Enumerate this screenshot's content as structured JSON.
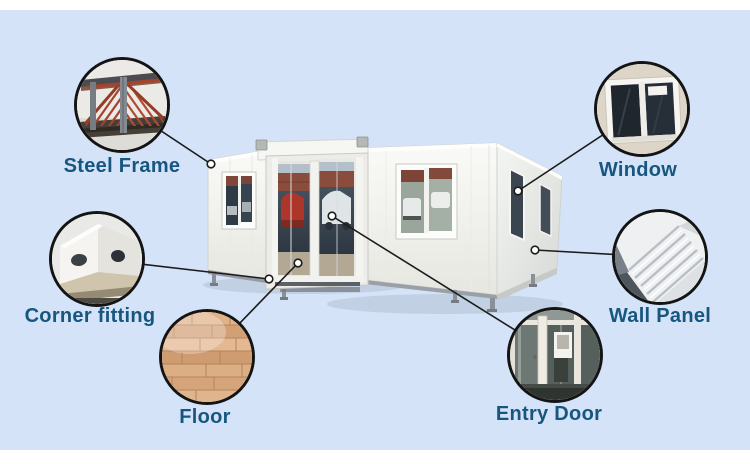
{
  "callouts": [
    {
      "id": "steel-frame",
      "label": "Steel Frame"
    },
    {
      "id": "window",
      "label": "Window"
    },
    {
      "id": "corner-fitting",
      "label": "Corner fitting"
    },
    {
      "id": "wall-panel",
      "label": "Wall Panel"
    },
    {
      "id": "floor",
      "label": "Floor"
    },
    {
      "id": "entry-door",
      "label": "Entry Door"
    }
  ],
  "style": {
    "background_color": "#d4e3f7",
    "frame_color": "#ffffff",
    "label_color": "#17567f",
    "line_color": "#1c1c1c",
    "circle_border_color": "#141414"
  }
}
